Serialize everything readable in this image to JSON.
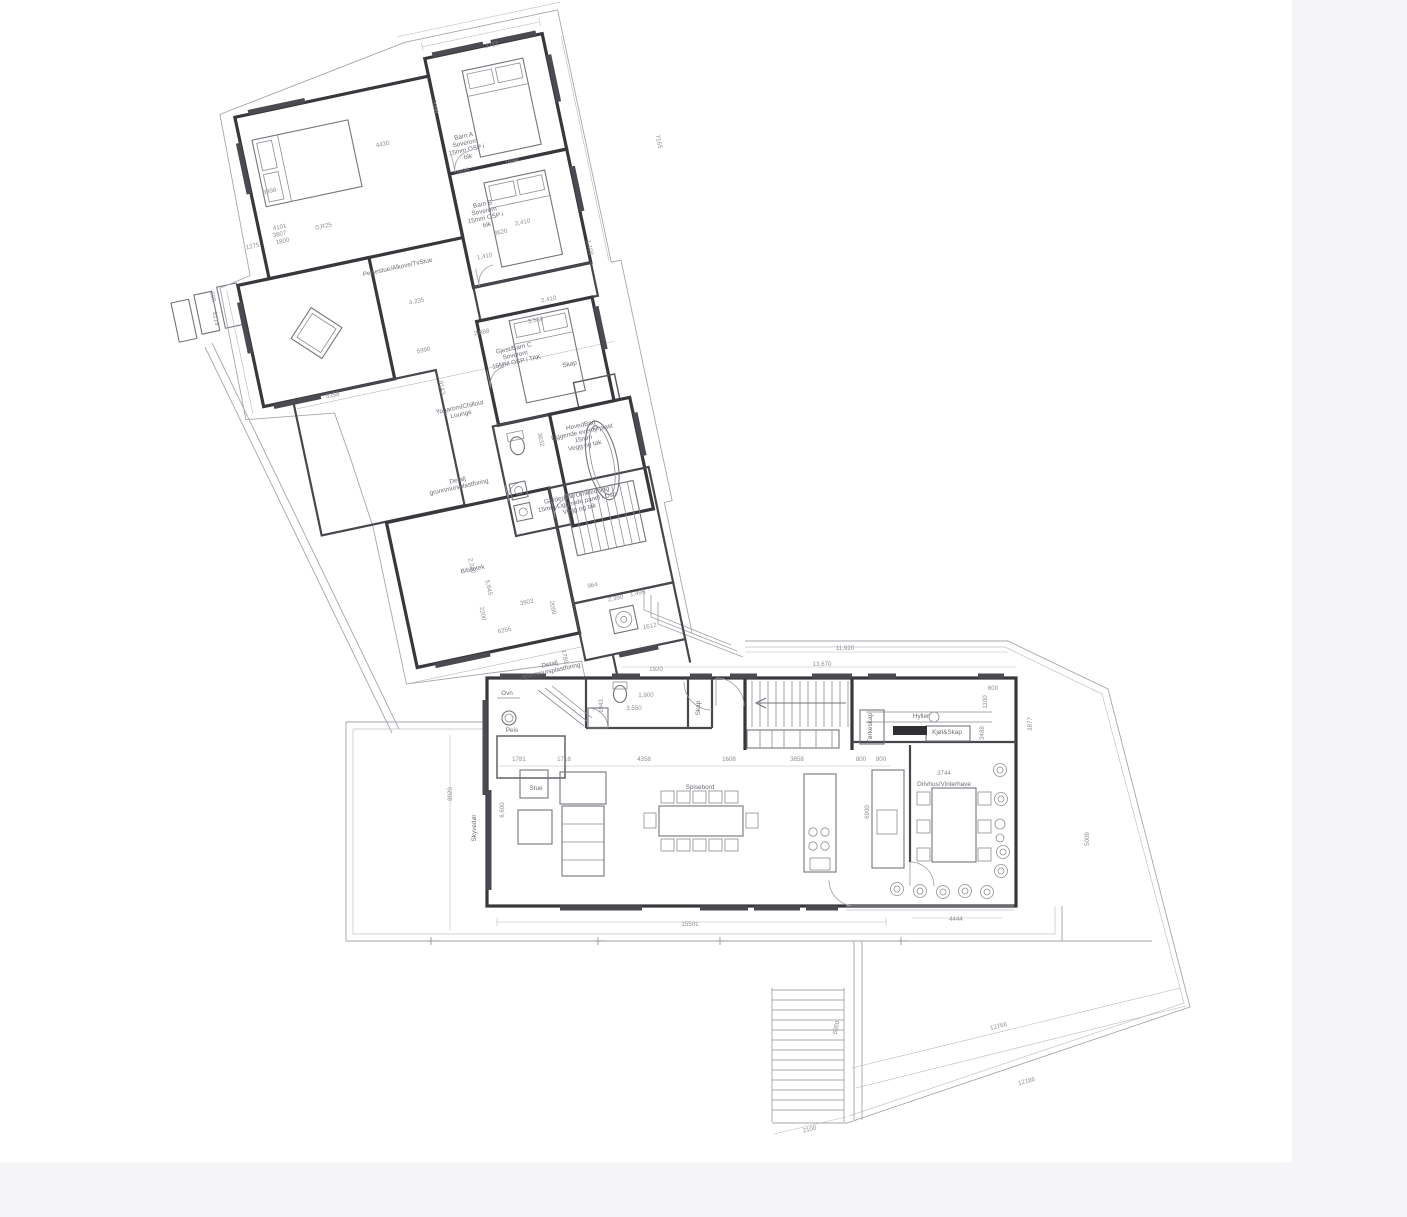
{
  "palette": {
    "background": "#ffffff",
    "wall": "#37373c",
    "window": "#4a4a50",
    "site_line": "#a6a6ad",
    "furniture_line": "#74747c",
    "dimension_text": "#8f8f98",
    "label_text": "#6d6d76",
    "margin_strip": "#f5f5f7"
  },
  "dim_labels": [
    {
      "t": "3717",
      "x": 492,
      "y": 47,
      "r": -12
    },
    {
      "t": "2098",
      "x": 433,
      "y": 107,
      "r": 78
    },
    {
      "t": "4430",
      "x": 383,
      "y": 146,
      "r": -12
    },
    {
      "t": "1835",
      "x": 463,
      "y": 173,
      "r": -12
    },
    {
      "t": "1694",
      "x": 512,
      "y": 163,
      "r": -12
    },
    {
      "t": "7165",
      "x": 657,
      "y": 142,
      "r": 78
    },
    {
      "t": "1,100",
      "x": 588,
      "y": 248,
      "r": 78
    },
    {
      "t": "0,R25",
      "x": 324,
      "y": 228,
      "r": -12
    },
    {
      "t": "3998",
      "x": 270,
      "y": 193,
      "r": -12
    },
    {
      "t": "4101",
      "x": 280,
      "y": 229,
      "r": -12,
      "fs": 5.4
    },
    {
      "t": "3807",
      "x": 280,
      "y": 236,
      "r": -12,
      "fs": 5.4
    },
    {
      "t": "1800",
      "x": 283,
      "y": 243,
      "r": -12,
      "fs": 5.4
    },
    {
      "t": "1275",
      "x": 253,
      "y": 248,
      "r": -12
    },
    {
      "t": "608",
      "x": 211,
      "y": 297,
      "r": 78
    },
    {
      "t": "8219",
      "x": 214,
      "y": 319,
      "r": 78
    },
    {
      "t": "2,410",
      "x": 523,
      "y": 224,
      "r": -12
    },
    {
      "t": "3620",
      "x": 501,
      "y": 234,
      "r": -12
    },
    {
      "t": "1,410",
      "x": 485,
      "y": 258,
      "r": -12
    },
    {
      "t": "4.235",
      "x": 417,
      "y": 303,
      "r": -12
    },
    {
      "t": "2.888",
      "x": 482,
      "y": 334,
      "r": -12
    },
    {
      "t": "2.410",
      "x": 549,
      "y": 301,
      "r": -12
    },
    {
      "t": "3.580",
      "x": 536,
      "y": 322,
      "r": -12
    },
    {
      "t": "5990",
      "x": 424,
      "y": 352,
      "r": -12
    },
    {
      "t": "9143",
      "x": 440,
      "y": 388,
      "r": 78
    },
    {
      "t": "5358",
      "x": 333,
      "y": 397,
      "r": -12
    },
    {
      "t": "3632",
      "x": 539,
      "y": 440,
      "r": 78
    },
    {
      "t": "2,240",
      "x": 470,
      "y": 566,
      "r": 78
    },
    {
      "t": "5,845",
      "x": 487,
      "y": 588,
      "r": 78
    },
    {
      "t": "2200",
      "x": 481,
      "y": 614,
      "r": 78
    },
    {
      "t": "3903",
      "x": 527,
      "y": 604,
      "r": -12
    },
    {
      "t": "2099",
      "x": 551,
      "y": 608,
      "r": 78
    },
    {
      "t": "964",
      "x": 593,
      "y": 587,
      "r": -12
    },
    {
      "t": "2,390",
      "x": 616,
      "y": 600,
      "r": -12
    },
    {
      "t": "1,495",
      "x": 638,
      "y": 595,
      "r": -12
    },
    {
      "t": "1612",
      "x": 650,
      "y": 628,
      "r": -12
    },
    {
      "t": "1789",
      "x": 563,
      "y": 657,
      "r": 78
    },
    {
      "t": "6256",
      "x": 505,
      "y": 632,
      "r": -12
    },
    {
      "t": "1781",
      "x": 519,
      "y": 761
    },
    {
      "t": "1718",
      "x": 564,
      "y": 761
    },
    {
      "t": "4358",
      "x": 644,
      "y": 761
    },
    {
      "t": "1608",
      "x": 729,
      "y": 761
    },
    {
      "t": "3858",
      "x": 797,
      "y": 761
    },
    {
      "t": "800",
      "x": 861,
      "y": 761
    },
    {
      "t": "800",
      "x": 881,
      "y": 761
    },
    {
      "t": "1,900",
      "x": 646,
      "y": 697
    },
    {
      "t": "3,550",
      "x": 634,
      "y": 710
    },
    {
      "t": "1943",
      "x": 603,
      "y": 706,
      "r": -90
    },
    {
      "t": "1920",
      "x": 656,
      "y": 671
    },
    {
      "t": "11,920",
      "x": 845,
      "y": 650
    },
    {
      "t": "13,670",
      "x": 822,
      "y": 666
    },
    {
      "t": "600",
      "x": 993,
      "y": 690
    },
    {
      "t": "1100",
      "x": 987,
      "y": 702,
      "r": -90
    },
    {
      "t": "3488",
      "x": 984,
      "y": 733,
      "r": -90
    },
    {
      "t": "3877",
      "x": 1032,
      "y": 724,
      "r": -90
    },
    {
      "t": "6900",
      "x": 869,
      "y": 812,
      "r": -90
    },
    {
      "t": "5009",
      "x": 1089,
      "y": 839,
      "r": -90
    },
    {
      "t": "6,600",
      "x": 504,
      "y": 810,
      "r": -90
    },
    {
      "t": "8920",
      "x": 452,
      "y": 794,
      "r": -90
    },
    {
      "t": "4444",
      "x": 956,
      "y": 921
    },
    {
      "t": "15501",
      "x": 690,
      "y": 926
    },
    {
      "t": "3744",
      "x": 944,
      "y": 775
    },
    {
      "t": "2100",
      "x": 810,
      "y": 1131,
      "r": -14
    },
    {
      "t": "12766",
      "x": 999,
      "y": 1028,
      "r": -14
    },
    {
      "t": "12186",
      "x": 1027,
      "y": 1083,
      "r": -14
    },
    {
      "t": "6060",
      "x": 838,
      "y": 1028,
      "r": -78
    }
  ],
  "room_labels": [
    {
      "t": "Barn A",
      "x": 464,
      "y": 138,
      "r": -12,
      "fs": 5.8,
      "n": "room-label-barn-a"
    },
    {
      "t": "Soverom",
      "x": 465.5,
      "y": 144.9,
      "r": -12,
      "fs": 5.8,
      "n": "room-label-barn-a-l2"
    },
    {
      "t": "15mm OSP i",
      "x": 466.9,
      "y": 151.7,
      "r": -12,
      "fs": 5.8,
      "n": "room-label-barn-a-l3"
    },
    {
      "t": "blk",
      "x": 468.4,
      "y": 158.6,
      "r": -12,
      "fs": 5.8,
      "n": "room-label-barn-a-l4"
    },
    {
      "t": "Barn B",
      "x": 483,
      "y": 206,
      "r": -12,
      "fs": 5.8,
      "n": "room-label-barn-b"
    },
    {
      "t": "Soverom",
      "x": 484.5,
      "y": 212.9,
      "r": -12,
      "fs": 5.8,
      "n": "room-label-barn-b-l2"
    },
    {
      "t": "15mm OSP i",
      "x": 485.9,
      "y": 219.7,
      "r": -12,
      "fs": 5.8,
      "n": "room-label-barn-b-l3"
    },
    {
      "t": "blk",
      "x": 487.4,
      "y": 226.6,
      "r": -12,
      "fs": 5.8,
      "n": "room-label-barn-b-l4"
    },
    {
      "t": "Gjest/Barn C",
      "x": 514,
      "y": 350,
      "r": -12,
      "fs": 5.8,
      "n": "room-label-gjest-barn-c"
    },
    {
      "t": "Soverom",
      "x": 515.5,
      "y": 356.9,
      "r": -12,
      "fs": 5.8,
      "n": "room-label-gjest-barn-c-l2"
    },
    {
      "t": "15MM OSP i TAK",
      "x": 516.9,
      "y": 363.7,
      "r": -12,
      "fs": 5.8,
      "n": "room-label-gjest-barn-c-l3"
    },
    {
      "t": "Skap",
      "x": 570,
      "y": 366,
      "r": -12,
      "fs": 5.4,
      "n": "room-label-skap-upper"
    },
    {
      "t": "HovedBad",
      "x": 581,
      "y": 427,
      "r": -12,
      "fs": 5.4,
      "n": "room-label-hovedbad"
    },
    {
      "t": "Liggende eventyrplast",
      "x": 582.4,
      "y": 433.8,
      "r": -12,
      "fs": 5.4,
      "n": "room-label-hovedbad-l2"
    },
    {
      "t": "15mm",
      "x": 583.8,
      "y": 440.6,
      "r": -12,
      "fs": 5.4,
      "n": "room-label-hovedbad-l3"
    },
    {
      "t": "Vegg og tak",
      "x": 585.2,
      "y": 447.4,
      "r": -12,
      "fs": 5.4,
      "n": "room-label-hovedbad-l4"
    },
    {
      "t": "Peisestue/Alkove/TvStue",
      "x": 398,
      "y": 269,
      "r": -12,
      "fs": 6,
      "n": "room-label-peisestue"
    },
    {
      "t": "Yogarom/Chillout",
      "x": 460,
      "y": 409,
      "r": -12,
      "fs": 6,
      "n": "room-label-yogarom"
    },
    {
      "t": "Lounge",
      "x": 461.5,
      "y": 416,
      "r": -12,
      "fs": 6,
      "n": "room-label-yogarom-l2"
    },
    {
      "t": "Bibliotek",
      "x": 473,
      "y": 571,
      "r": -12,
      "fs": 6.2,
      "n": "room-label-bibliotek"
    },
    {
      "t": "Garderobe/Omkledning",
      "x": 577,
      "y": 497,
      "r": -12,
      "fs": 5.4,
      "n": "room-label-garderobe"
    },
    {
      "t": "15mm Liggende panel i Osp.",
      "x": 578.4,
      "y": 503.8,
      "r": -12,
      "fs": 5.4,
      "n": "room-label-garderobe-l2"
    },
    {
      "t": "Vegg og tak",
      "x": 579.8,
      "y": 510.6,
      "r": -12,
      "fs": 5.4,
      "n": "room-label-garderobe-l3"
    },
    {
      "t": "Detalj",
      "x": 550,
      "y": 666,
      "r": -12,
      "fs": 5.2,
      "n": "note-detalj-1"
    },
    {
      "t": "grunnmursplastforing",
      "x": 551.4,
      "y": 672.8,
      "r": -12,
      "fs": 5.2,
      "n": "note-detalj-1-l2"
    },
    {
      "t": "Detalj",
      "x": 458,
      "y": 482,
      "r": -12,
      "fs": 5.2,
      "n": "note-detalj-2"
    },
    {
      "t": "grunnmursplastforing",
      "x": 459.4,
      "y": 488.8,
      "r": -12,
      "fs": 5.2,
      "n": "note-detalj-2-l2"
    },
    {
      "t": "Ovn",
      "x": 507,
      "y": 695,
      "fs": 5.6,
      "n": "room-label-ovn"
    },
    {
      "t": "Peis",
      "x": 512,
      "y": 732,
      "fs": 5.6,
      "n": "room-label-peis"
    },
    {
      "t": "Stue",
      "x": 536,
      "y": 790,
      "fs": 6.2,
      "n": "room-label-stue"
    },
    {
      "t": "Spisebord",
      "x": 700,
      "y": 789,
      "fs": 6.2,
      "n": "room-label-spisebord"
    },
    {
      "t": "Skap",
      "x": 700,
      "y": 708,
      "r": -90,
      "fs": 5.6,
      "n": "room-label-skap-lower"
    },
    {
      "t": "Tørkeskap",
      "x": 872,
      "y": 728,
      "r": -90,
      "fs": 5,
      "n": "room-label-torkeskap"
    },
    {
      "t": "Hyller",
      "x": 921,
      "y": 718,
      "fs": 5.6,
      "n": "room-label-hyller"
    },
    {
      "t": "Kjøl&Skap",
      "x": 947,
      "y": 734,
      "fs": 5.2,
      "n": "room-label-kjol-skap"
    },
    {
      "t": "Drivhus/Vinterhave",
      "x": 944,
      "y": 786,
      "fs": 6,
      "n": "room-label-drivhus"
    },
    {
      "t": "Skyvedør",
      "x": 476,
      "y": 828,
      "r": -90,
      "fs": 5.6,
      "n": "room-label-skyvedor"
    }
  ]
}
